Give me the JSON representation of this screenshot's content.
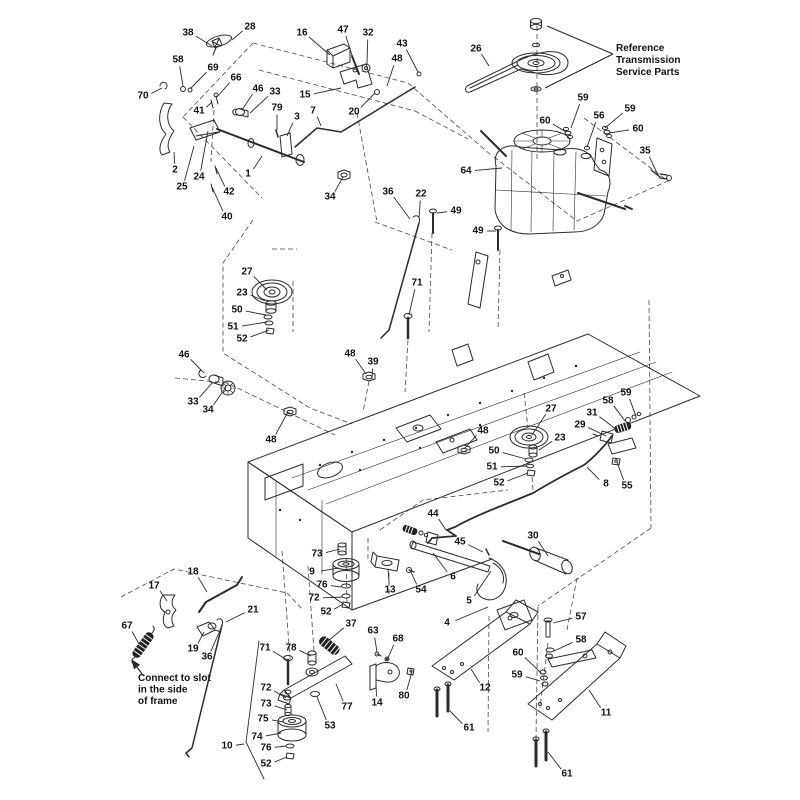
{
  "figure": {
    "type": "exploded-parts-diagram",
    "subject": "Riding mower transmission drive group exploded view",
    "canvas": {
      "width": 800,
      "height": 800
    },
    "colors": {
      "background": "#ffffff",
      "line": "#2b2b2b",
      "label": "#111111",
      "phantom_dash": "#4a4a4a"
    },
    "annotations": [
      {
        "name": "reference-transmission-note",
        "x": 616,
        "y": 51,
        "line_height": 12,
        "arrowhead": false,
        "lines": [
          "Reference",
          "Transmission",
          "Service Parts"
        ],
        "arrows": [
          [
            613,
            54,
            547,
            26
          ],
          [
            613,
            54,
            545,
            88
          ]
        ]
      },
      {
        "name": "connect-to-slot-note",
        "x": 138,
        "y": 681,
        "line_height": 11.5,
        "arrowhead": true,
        "lines": [
          "Connect to slot",
          "in the side",
          "of frame"
        ],
        "arrows": [
          [
            142,
            674,
            132,
            660
          ]
        ]
      }
    ],
    "labels": [
      {
        "n": "38",
        "x": 188,
        "y": 33,
        "tx": 212,
        "ty": 46
      },
      {
        "n": "28",
        "x": 250,
        "y": 27,
        "tx": 232,
        "ty": 40
      },
      {
        "n": "16",
        "x": 302,
        "y": 33,
        "tx": 330,
        "ty": 55
      },
      {
        "n": "47",
        "x": 343,
        "y": 30,
        "tx": 356,
        "ty": 68
      },
      {
        "n": "32",
        "x": 368,
        "y": 33,
        "tx": 367,
        "ty": 64
      },
      {
        "n": "43",
        "x": 402,
        "y": 44,
        "tx": 418,
        "ty": 72
      },
      {
        "n": "48",
        "x": 397,
        "y": 59,
        "tx": 387,
        "ty": 86
      },
      {
        "n": "58",
        "x": 178,
        "y": 60,
        "tx": 183,
        "ty": 86
      },
      {
        "n": "69",
        "x": 213,
        "y": 68,
        "tx": 191,
        "ty": 88
      },
      {
        "n": "66",
        "x": 236,
        "y": 78,
        "tx": 218,
        "ty": 96
      },
      {
        "n": "70",
        "x": 143,
        "y": 96,
        "tx": 162,
        "ty": 88
      },
      {
        "n": "41",
        "x": 199,
        "y": 111,
        "tx": 212,
        "ty": 102
      },
      {
        "n": "46",
        "x": 258,
        "y": 89,
        "tx": 242,
        "ty": 110
      },
      {
        "n": "33",
        "x": 275,
        "y": 92,
        "tx": 250,
        "ty": 113
      },
      {
        "n": "79",
        "x": 277,
        "y": 108,
        "tx": 277,
        "ty": 130
      },
      {
        "n": "3",
        "x": 297,
        "y": 117,
        "tx": 287,
        "ty": 136
      },
      {
        "n": "7",
        "x": 313,
        "y": 111,
        "tx": 321,
        "ty": 126
      },
      {
        "n": "15",
        "x": 305,
        "y": 95,
        "tx": 341,
        "ty": 88
      },
      {
        "n": "20",
        "x": 354,
        "y": 112,
        "tx": 375,
        "ty": 93
      },
      {
        "n": "2",
        "x": 175,
        "y": 170,
        "tx": 174,
        "ty": 152
      },
      {
        "n": "25",
        "x": 182,
        "y": 187,
        "tx": 194,
        "ty": 146
      },
      {
        "n": "24",
        "x": 199,
        "y": 177,
        "tx": 208,
        "ty": 131
      },
      {
        "n": "1",
        "x": 248,
        "y": 174,
        "tx": 262,
        "ty": 156
      },
      {
        "n": "42",
        "x": 229,
        "y": 192,
        "tx": 216,
        "ty": 168
      },
      {
        "n": "40",
        "x": 227,
        "y": 217,
        "tx": 212,
        "ty": 187
      },
      {
        "n": "34",
        "x": 330,
        "y": 197,
        "tx": 343,
        "ty": 177
      },
      {
        "n": "36",
        "x": 388,
        "y": 192,
        "tx": 410,
        "ty": 219
      },
      {
        "n": "22",
        "x": 421,
        "y": 194,
        "tx": 419,
        "ty": 218
      },
      {
        "n": "26",
        "x": 476,
        "y": 49,
        "tx": 489,
        "ty": 66
      },
      {
        "n": "59",
        "x": 583,
        "y": 98,
        "tx": 571,
        "ty": 128
      },
      {
        "n": "60",
        "x": 545,
        "y": 121,
        "tx": 566,
        "ty": 132
      },
      {
        "n": "56",
        "x": 599,
        "y": 116,
        "tx": 587,
        "ty": 147
      },
      {
        "n": "59",
        "x": 630,
        "y": 109,
        "tx": 605,
        "ty": 128
      },
      {
        "n": "60",
        "x": 638,
        "y": 129,
        "tx": 609,
        "ty": 133
      },
      {
        "n": "35",
        "x": 645,
        "y": 151,
        "tx": 658,
        "ty": 175
      },
      {
        "n": "64",
        "x": 466,
        "y": 171,
        "tx": 502,
        "ty": 168
      },
      {
        "n": "49",
        "x": 456,
        "y": 211,
        "tx": 437,
        "ty": 213
      },
      {
        "n": "49",
        "x": 478,
        "y": 231,
        "tx": 496,
        "ty": 231
      },
      {
        "n": "71",
        "x": 417,
        "y": 283,
        "tx": 409,
        "ty": 315
      },
      {
        "n": "27",
        "x": 247,
        "y": 272,
        "tx": 267,
        "ty": 290
      },
      {
        "n": "23",
        "x": 242,
        "y": 293,
        "tx": 265,
        "ty": 301
      },
      {
        "n": "50",
        "x": 237,
        "y": 310,
        "tx": 266,
        "ty": 315
      },
      {
        "n": "51",
        "x": 233,
        "y": 327,
        "tx": 267,
        "ty": 322
      },
      {
        "n": "52",
        "x": 242,
        "y": 339,
        "tx": 269,
        "ty": 330
      },
      {
        "n": "46",
        "x": 184,
        "y": 355,
        "tx": 204,
        "ty": 373
      },
      {
        "n": "33",
        "x": 193,
        "y": 402,
        "tx": 213,
        "ty": 382
      },
      {
        "n": "34",
        "x": 208,
        "y": 410,
        "tx": 226,
        "ty": 387
      },
      {
        "n": "48",
        "x": 350,
        "y": 354,
        "tx": 366,
        "ty": 374
      },
      {
        "n": "39",
        "x": 373,
        "y": 362,
        "tx": 372,
        "ty": 379
      },
      {
        "n": "48",
        "x": 271,
        "y": 440,
        "tx": 288,
        "ty": 412
      },
      {
        "n": "48",
        "x": 483,
        "y": 431,
        "tx": 464,
        "ty": 449
      },
      {
        "n": "27",
        "x": 551,
        "y": 409,
        "tx": 532,
        "ty": 435
      },
      {
        "n": "23",
        "x": 560,
        "y": 438,
        "tx": 539,
        "ty": 450
      },
      {
        "n": "58",
        "x": 608,
        "y": 401,
        "tx": 625,
        "ty": 421
      },
      {
        "n": "59",
        "x": 626,
        "y": 393,
        "tx": 636,
        "ty": 416
      },
      {
        "n": "31",
        "x": 592,
        "y": 413,
        "tx": 617,
        "ty": 430
      },
      {
        "n": "29",
        "x": 580,
        "y": 425,
        "tx": 606,
        "ty": 436
      },
      {
        "n": "50",
        "x": 494,
        "y": 451,
        "tx": 526,
        "ty": 459
      },
      {
        "n": "51",
        "x": 492,
        "y": 467,
        "tx": 527,
        "ty": 466
      },
      {
        "n": "52",
        "x": 499,
        "y": 483,
        "tx": 528,
        "ty": 473
      },
      {
        "n": "8",
        "x": 606,
        "y": 484,
        "tx": 587,
        "ty": 467
      },
      {
        "n": "55",
        "x": 627,
        "y": 486,
        "tx": 617,
        "ty": 462
      },
      {
        "n": "44",
        "x": 433,
        "y": 514,
        "tx": 446,
        "ty": 530
      },
      {
        "n": "45",
        "x": 460,
        "y": 542,
        "tx": 483,
        "ty": 552
      },
      {
        "n": "30",
        "x": 533,
        "y": 536,
        "tx": 548,
        "ty": 556
      },
      {
        "n": "17",
        "x": 154,
        "y": 586,
        "tx": 167,
        "ty": 601
      },
      {
        "n": "18",
        "x": 193,
        "y": 572,
        "tx": 207,
        "ty": 592
      },
      {
        "n": "67",
        "x": 127,
        "y": 626,
        "tx": 139,
        "ty": 644
      },
      {
        "n": "21",
        "x": 253,
        "y": 610,
        "tx": 226,
        "ty": 622
      },
      {
        "n": "19",
        "x": 193,
        "y": 649,
        "tx": 204,
        "ty": 632
      },
      {
        "n": "36",
        "x": 207,
        "y": 657,
        "tx": 221,
        "ty": 628
      },
      {
        "n": "73",
        "x": 317,
        "y": 554,
        "tx": 340,
        "ty": 549
      },
      {
        "n": "9",
        "x": 312,
        "y": 572,
        "tx": 339,
        "ty": 568
      },
      {
        "n": "76",
        "x": 322,
        "y": 585,
        "tx": 341,
        "ty": 587
      },
      {
        "n": "72",
        "x": 314,
        "y": 598,
        "tx": 342,
        "ty": 597
      },
      {
        "n": "52",
        "x": 326,
        "y": 612,
        "tx": 343,
        "ty": 604
      },
      {
        "n": "13",
        "x": 390,
        "y": 590,
        "tx": 388,
        "ty": 569
      },
      {
        "n": "54",
        "x": 421,
        "y": 590,
        "tx": 411,
        "ty": 572
      },
      {
        "n": "6",
        "x": 453,
        "y": 577,
        "tx": 433,
        "ty": 553
      },
      {
        "n": "5",
        "x": 469,
        "y": 601,
        "tx": 491,
        "ty": 571
      },
      {
        "n": "4",
        "x": 447,
        "y": 623,
        "tx": 488,
        "ty": 607
      },
      {
        "n": "37",
        "x": 351,
        "y": 624,
        "tx": 328,
        "ty": 641
      },
      {
        "n": "63",
        "x": 373,
        "y": 631,
        "tx": 377,
        "ty": 652
      },
      {
        "n": "68",
        "x": 398,
        "y": 639,
        "tx": 388,
        "ty": 658
      },
      {
        "n": "71",
        "x": 265,
        "y": 648,
        "tx": 287,
        "ty": 660
      },
      {
        "n": "78",
        "x": 291,
        "y": 648,
        "tx": 311,
        "ty": 656
      },
      {
        "n": "72",
        "x": 266,
        "y": 688,
        "tx": 286,
        "ty": 698
      },
      {
        "n": "73",
        "x": 266,
        "y": 704,
        "tx": 287,
        "ty": 710
      },
      {
        "n": "75",
        "x": 263,
        "y": 719,
        "tx": 284,
        "ty": 722
      },
      {
        "n": "74",
        "x": 257,
        "y": 737,
        "tx": 281,
        "ty": 733
      },
      {
        "n": "76",
        "x": 266,
        "y": 748,
        "tx": 286,
        "ty": 746
      },
      {
        "n": "52",
        "x": 266,
        "y": 764,
        "tx": 287,
        "ty": 757
      },
      {
        "n": "53",
        "x": 330,
        "y": 726,
        "tx": 317,
        "ty": 697
      },
      {
        "n": "77",
        "x": 347,
        "y": 707,
        "tx": 336,
        "ty": 684
      },
      {
        "n": "14",
        "x": 377,
        "y": 703,
        "tx": 376,
        "ty": 684
      },
      {
        "n": "80",
        "x": 404,
        "y": 696,
        "tx": 412,
        "ty": 672
      },
      {
        "n": "12",
        "x": 485,
        "y": 688,
        "tx": 471,
        "ty": 669
      },
      {
        "n": "61",
        "x": 469,
        "y": 728,
        "tx": 450,
        "ty": 711
      },
      {
        "n": "57",
        "x": 581,
        "y": 617,
        "tx": 553,
        "ty": 623
      },
      {
        "n": "58",
        "x": 581,
        "y": 640,
        "tx": 554,
        "ty": 651
      },
      {
        "n": "60",
        "x": 518,
        "y": 653,
        "tx": 541,
        "ty": 673
      },
      {
        "n": "59",
        "x": 517,
        "y": 675,
        "tx": 540,
        "ty": 681
      },
      {
        "n": "11",
        "x": 606,
        "y": 713,
        "tx": 589,
        "ty": 690
      },
      {
        "n": "61",
        "x": 567,
        "y": 774,
        "tx": 548,
        "ty": 752
      },
      {
        "n": "10",
        "x": 227,
        "y": 746,
        "tx": 244,
        "ty": 744
      }
    ]
  }
}
